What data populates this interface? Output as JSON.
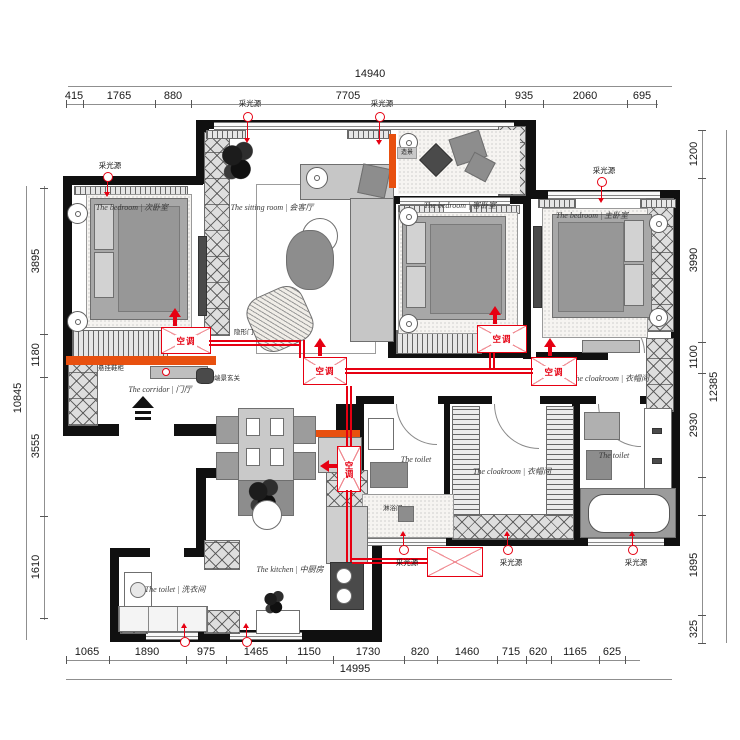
{
  "palette": {
    "wall": "#101010",
    "annotation_red": "#e60012",
    "accent_orange": "#e8500f"
  },
  "dims": {
    "top": {
      "total": "14940",
      "segments": [
        "415",
        "1765",
        "880",
        "7705",
        "935",
        "2060",
        "695"
      ]
    },
    "bottom": {
      "total": "14995",
      "segments": [
        "1065",
        "1890",
        "975",
        "1465",
        "1150",
        "1730",
        "820",
        "1460",
        "715",
        "620",
        "1165",
        "625"
      ]
    },
    "left": {
      "total": "10845",
      "segments": [
        "3895",
        "1180",
        "3555",
        "1610"
      ]
    },
    "right": {
      "total": "12385",
      "segments": [
        "1200",
        "3990",
        "1100",
        "2930",
        "1895",
        "325"
      ]
    }
  },
  "rooms": [
    {
      "id": "bedroom-secondary",
      "label": "The bedroom | 次卧室"
    },
    {
      "id": "sitting-room",
      "label": "The sitting room | 会客厅"
    },
    {
      "id": "bedroom-guest",
      "label": "The bedroom | 客卧室"
    },
    {
      "id": "bedroom-master",
      "label": "The bedroom | 主卧室"
    },
    {
      "id": "cloakroom-master",
      "label": "The cloakroom | 衣帽间"
    },
    {
      "id": "corridor",
      "label": "The corridor | 门厅"
    },
    {
      "id": "toilet-middle",
      "label": "The toilet"
    },
    {
      "id": "shower-room",
      "label": "淋浴间"
    },
    {
      "id": "cloakroom-middle",
      "label": "The cloakroom | 衣帽间"
    },
    {
      "id": "toilet-right",
      "label": "The toilet"
    },
    {
      "id": "kitchen",
      "label": "The kitchen | 中厨房"
    },
    {
      "id": "laundry",
      "label": "The toilet | 洗衣间"
    }
  ],
  "annotations": {
    "ac": "空调",
    "light_source": "采光源",
    "hidden_door": "隐形门",
    "shoe_cabinet": "悬挂鞋柜",
    "entry_feature": "端景玄关",
    "scenery": "造景"
  }
}
